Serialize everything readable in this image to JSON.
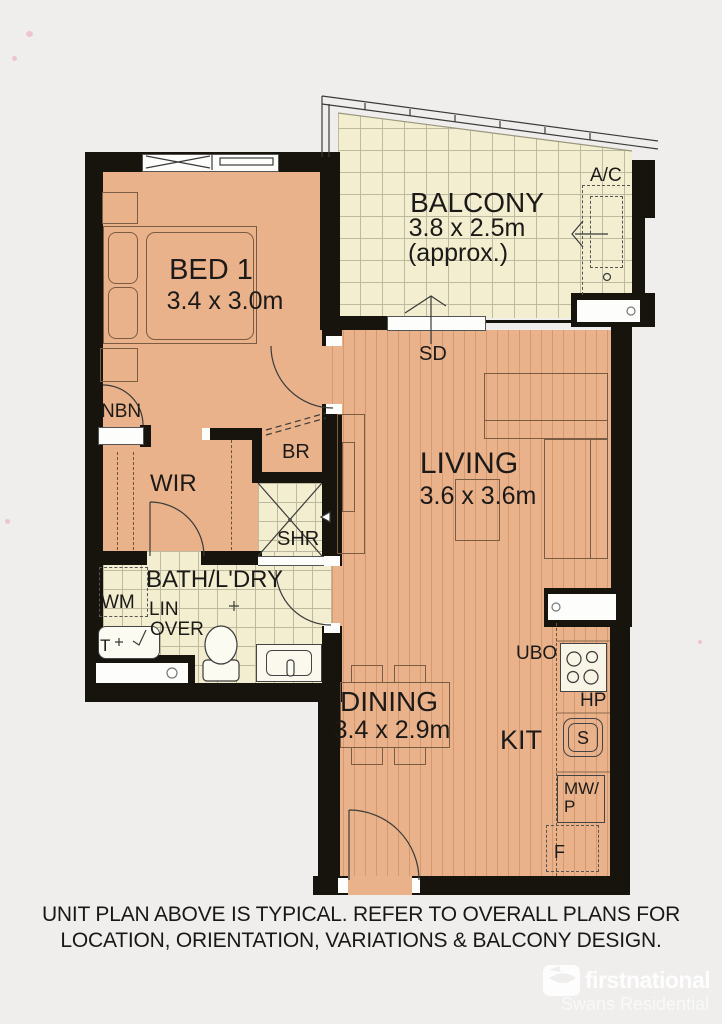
{
  "rooms": {
    "bed1": {
      "label": "BED 1",
      "dims": "3.4 x 3.0m"
    },
    "balcony": {
      "label": "BALCONY",
      "dims": "3.8 x 2.5m",
      "approx": "(approx.)"
    },
    "living": {
      "label": "LIVING",
      "dims": "3.6 x 3.6m"
    },
    "dining": {
      "label": "DINING",
      "dims": "3.4 x 2.9m"
    },
    "kitchen": {
      "label": "KIT"
    },
    "bath": {
      "label": "BATH/L'DRY"
    },
    "wir": {
      "label": "WIR"
    }
  },
  "fixtures": {
    "ac": "A/C",
    "sd": "SD",
    "nbn": "NBN",
    "br": "BR",
    "shr": "SHR",
    "wm": "WM",
    "lin": "LIN",
    "over": "OVER",
    "trough": "T",
    "ubo": "UBO",
    "hp": "HP",
    "sink": "S",
    "mw": "MW/",
    "p": "P",
    "fridge": "F"
  },
  "footer": {
    "line1": "UNIT PLAN ABOVE IS TYPICAL. REFER TO OVERALL PLANS FOR",
    "line2": "LOCATION, ORIENTATION, VARIATIONS & BALCONY DESIGN."
  },
  "brand": {
    "name": "firstnational",
    "sub": "Swans Residential"
  },
  "colors": {
    "floor": "#e9b28a",
    "tile": "#f2eecf",
    "wall": "#17140e",
    "stripe": "#a65e34",
    "background": "#efeeec"
  }
}
